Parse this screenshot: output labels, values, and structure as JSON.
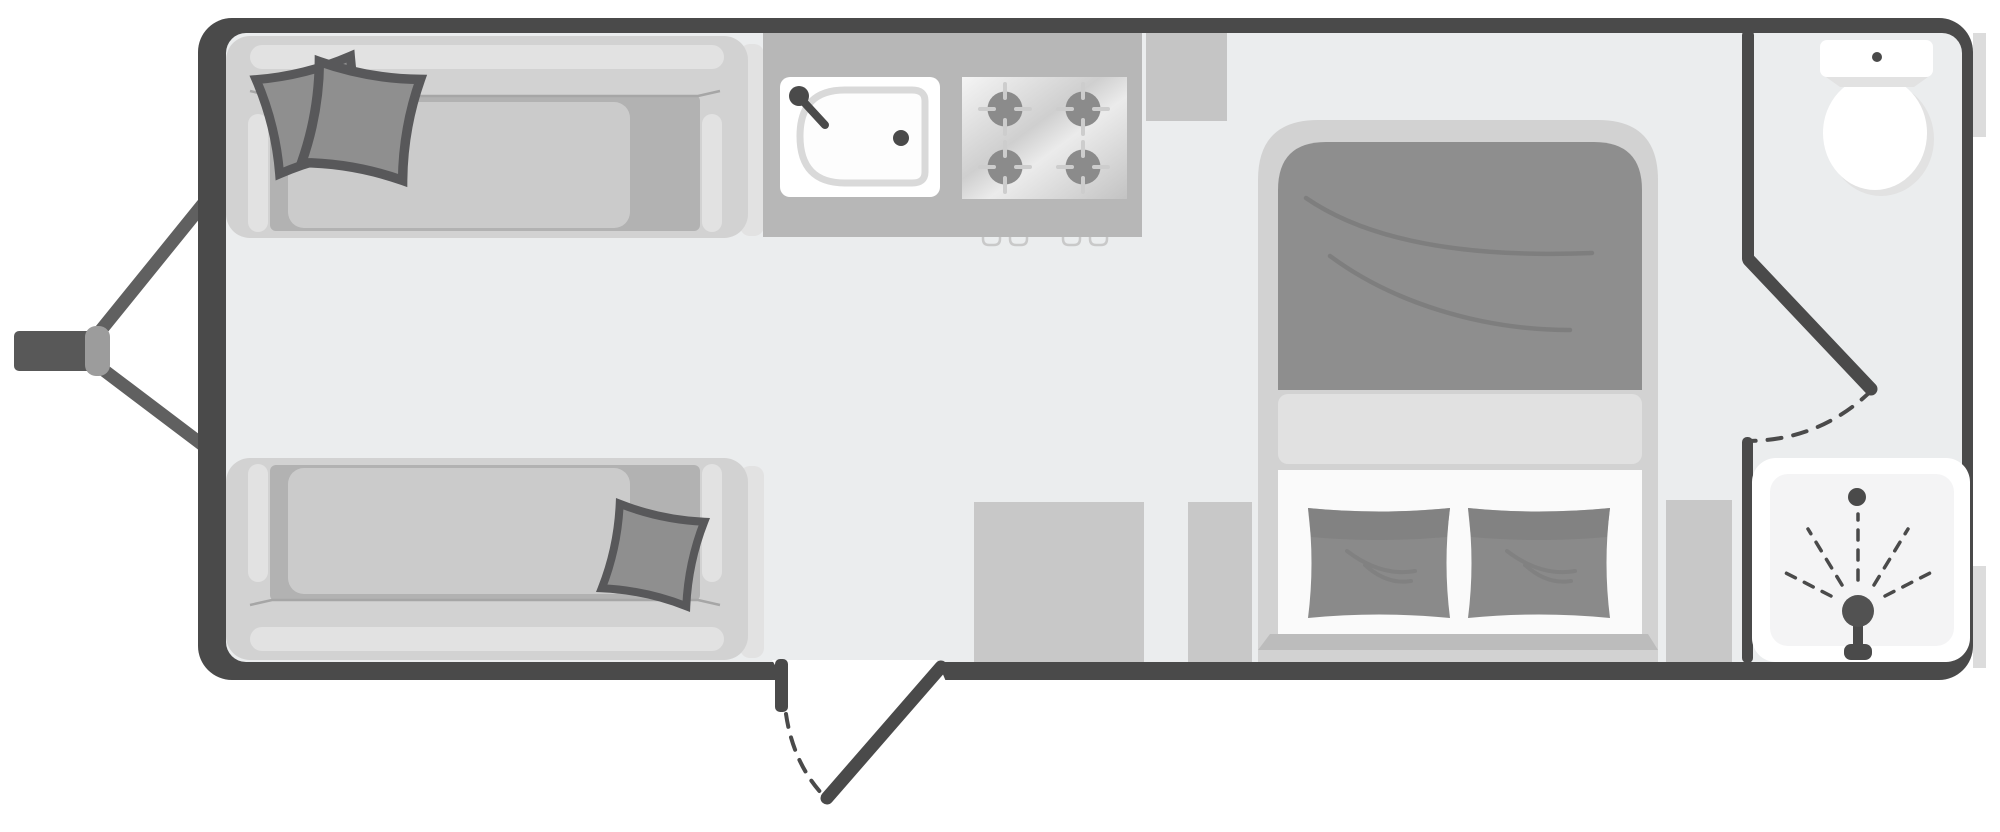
{
  "diagram": {
    "type": "caravan-floor-plan",
    "orientation": "hitch-on-left",
    "zones": [
      "front-lounge",
      "kitchen",
      "bedroom",
      "washroom"
    ],
    "fixtures": [
      {
        "id": "drawbar-hitch",
        "label": "A-frame drawbar with tow hitch",
        "zone": "exterior-front"
      },
      {
        "id": "sofa-nearside",
        "label": "Lounge sofa with two scatter cushions",
        "zone": "front-lounge"
      },
      {
        "id": "sofa-offside",
        "label": "Lounge sofa with one scatter cushion",
        "zone": "front-lounge"
      },
      {
        "id": "kitchen-worktop",
        "label": "Kitchen worktop",
        "zone": "kitchen"
      },
      {
        "id": "kitchen-sink",
        "label": "Sink with tap and drain",
        "zone": "kitchen"
      },
      {
        "id": "hob",
        "label": "Four-burner hob with control knobs",
        "zone": "kitchen"
      },
      {
        "id": "entry-door",
        "label": "Entry door with dashed swing arc",
        "zone": "kitchen"
      },
      {
        "id": "storage-units",
        "label": "Low storage units",
        "zone": "bedroom"
      },
      {
        "id": "island-bed",
        "label": "Double bed with duvet and two pillows",
        "zone": "bedroom"
      },
      {
        "id": "wardrobe",
        "label": "Bedside cabinet",
        "zone": "bedroom"
      },
      {
        "id": "washroom-door",
        "label": "Washroom door with dashed swing arc",
        "zone": "washroom"
      },
      {
        "id": "toilet",
        "label": "Toilet with cistern and flush button",
        "zone": "washroom"
      },
      {
        "id": "shower",
        "label": "Shower cubicle with shower head, spray and drain",
        "zone": "washroom"
      }
    ],
    "counts": {
      "scatter_cushions": 3,
      "hob_burners": 4,
      "hob_knobs": 4,
      "bed_pillows": 2,
      "doors": 2
    }
  },
  "colors": {
    "wall": "#4a4a4a",
    "floor": "#ebedee",
    "fixtureWhite": "#ffffff",
    "sofaFrame": "#d2d2d2",
    "sofaHighlight": "#e2e2e2",
    "seatWell": "#b2b2b2",
    "seatCushion": "#cbcbcb",
    "softShadow": "#e2e2e2",
    "pillow": "#8f8f8f",
    "pillowEdge": "#58585a",
    "worktop": "#b7b7b7",
    "worktopExt": "#c5c5c5",
    "burner": "#8b8b8b",
    "burnerTick": "#cdcdcd",
    "basinRing": "#d9d9d9",
    "hardware": "#4a4a4a",
    "bedShell": "#d2d2d2",
    "duvet": "#8e8e8e",
    "duvetCrease": "#7b7b7b",
    "sheet": "#e1e1e1",
    "mattress": "#fafafa",
    "bedPillow": "#8a8a8a",
    "bedPillowShade": "#7c7c7c",
    "footBand": "#bcbcbc",
    "cabinet": "#c8c8c8",
    "showerPanel": "#f4f4f5",
    "exteriorTrim": "#dcdcdc",
    "hitch": "#606060",
    "hitchBar": "#585858",
    "coupler": "#9c9c9c"
  }
}
